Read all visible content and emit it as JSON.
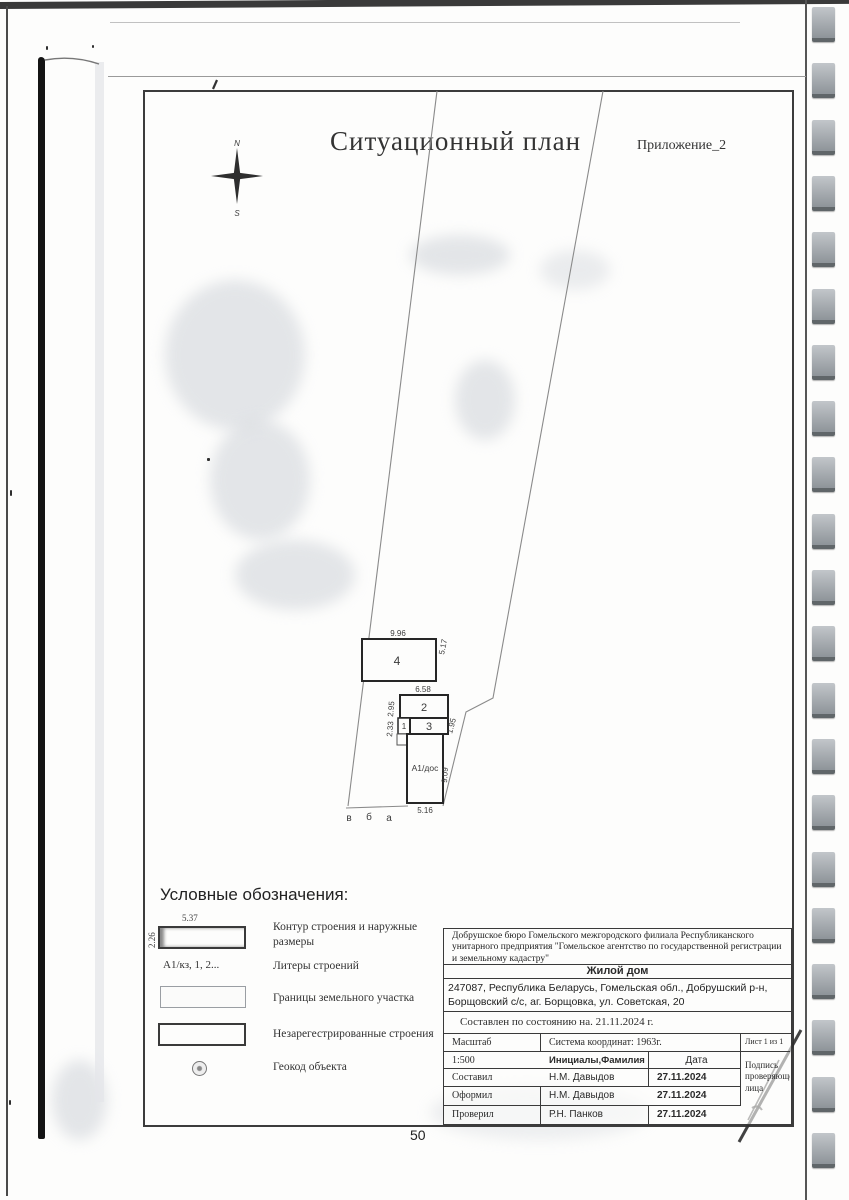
{
  "title": {
    "main": "Ситуационный план",
    "annex": "Приложение_2"
  },
  "compass": {
    "north": "N",
    "south": "S"
  },
  "plan": {
    "buildings": [
      {
        "label": "4"
      },
      {
        "label": "2"
      },
      {
        "label": "1"
      },
      {
        "label": "3"
      },
      {
        "label": "А1/дос"
      }
    ],
    "dims": {
      "b4_top": "9.96",
      "b4_right": "5.17",
      "b2_top": "6.58",
      "b2_left": "2.95",
      "b1_left": "2.33",
      "b3_right": "1.95",
      "main_right": "9.09",
      "main_bottom": "5.16"
    },
    "point_letters": [
      "в",
      "б",
      "а"
    ]
  },
  "legend": {
    "header": "Условные обозначения:",
    "sym_contour_top": "5.37",
    "sym_contour_left": "2.26",
    "sym_liters": "А1/кз, 1, 2...",
    "items": [
      {
        "label": "Контур строения и наружные размеры"
      },
      {
        "label": "Литеры строений"
      },
      {
        "label": "Границы земельного участка"
      },
      {
        "label": "Незарегестрированные строения"
      },
      {
        "label": "Геокод объекта"
      }
    ]
  },
  "stamp": {
    "organization": "Добрушское бюро Гомельского межгородского филиала Республиканского унитарного предприятия \"Гомельское агентство по государственной регистрации и земельному кадастру\"",
    "object_type": "Жилой дом",
    "address": "247087, Республика Беларусь, Гомельская обл., Добрушский р-н, Борщовский с/с, аг. Борщовка, ул. Советская, 20",
    "compiled": "Составлен по состоянию на. 21.11.2024 г.",
    "scale_label": "Масштаб",
    "scale_value": "1:500",
    "coord_system": "Система координат: 1963г.",
    "sheet": "Лист 1 из 1",
    "name_header": "Инициалы,Фамилия",
    "date_header": "Дата",
    "signature_label": "Подпись проверяющего лица",
    "rows": [
      {
        "role": "Составил",
        "name": "Н.М. Давыдов",
        "date": "27.11.2024"
      },
      {
        "role": "Оформил",
        "name": "Н.М. Давыдов",
        "date": "27.11.2024"
      },
      {
        "role": "Проверил",
        "name": "Р.Н. Панков",
        "date": "27.11.2024"
      }
    ]
  },
  "page": {
    "number": "50"
  }
}
